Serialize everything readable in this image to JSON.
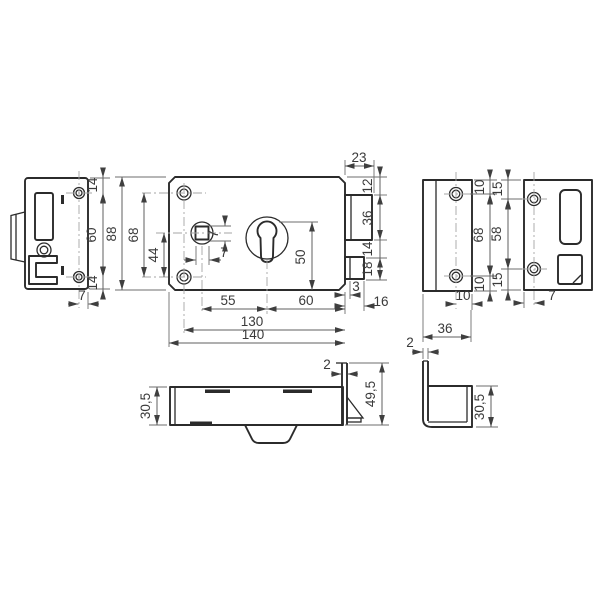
{
  "drawing_type": "technical-drawing-lock",
  "colors": {
    "background": "#ffffff",
    "outline": "#2b2b2b",
    "dimension_line": "#5f5f5f",
    "text": "#3a3a3a",
    "centerline": "#a6a6a6"
  },
  "views": {
    "faceplate_side": {
      "dims": {
        "top_to_hole": "14",
        "hole_spacing": "60",
        "hole_to_bottom": "14",
        "axis_to_edge": "7"
      }
    },
    "lock_body": {
      "dims": {
        "total_height": "88",
        "screw_hole_spacing": "68",
        "spindle_to_screw": "44",
        "spindle_width": "7",
        "spindle_height": "7",
        "cylinder_to_bottom": "50",
        "spindle_to_cylinder": "55",
        "cylinder_to_edge": "60",
        "screw_to_edge": "130",
        "total_width": "140",
        "latch_projection": "23",
        "top_to_latch": "12",
        "latch_height": "36",
        "latch_to_bolt": "14",
        "bolt_height": "18",
        "bolt_face": "3",
        "bolt_throw": "16"
      }
    },
    "strike_box_front": {
      "dims": {
        "top_to_hole": "10",
        "hole_spacing": "68",
        "hole_to_bottom": "10",
        "axis_to_edge": "10",
        "width": "36"
      }
    },
    "strike_plate": {
      "dims": {
        "top_to_hole": "15",
        "hole_spacing": "58",
        "hole_to_bottom": "15",
        "edge_to_axis": "7"
      }
    },
    "lock_top": {
      "dims": {
        "case_depth": "30,5",
        "faceplate_thickness": "2",
        "faceplate_height": "49,5"
      }
    },
    "strike_box_side": {
      "dims": {
        "sheet_thickness": "2",
        "depth": "30,5"
      }
    }
  }
}
